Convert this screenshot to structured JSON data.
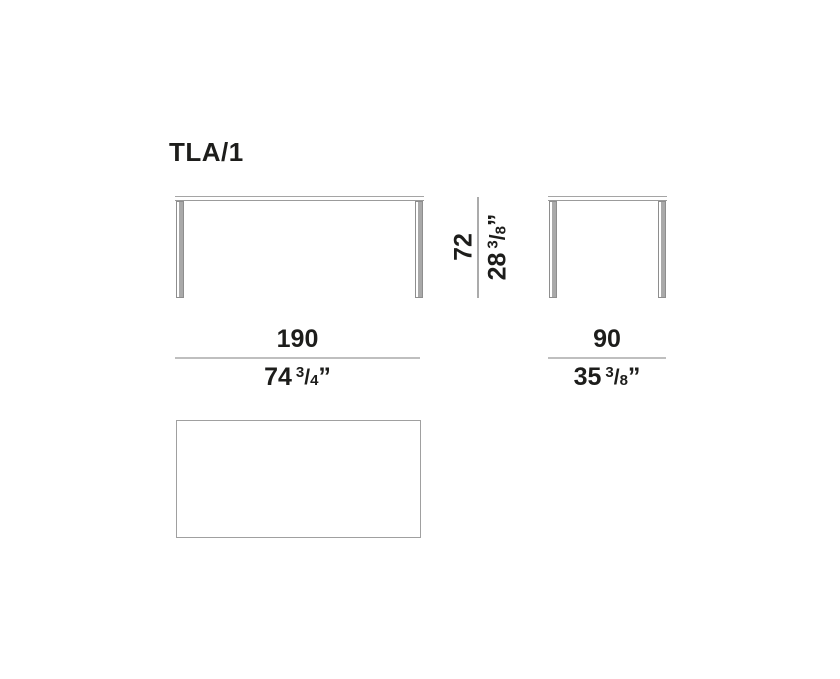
{
  "product": {
    "code": "TLA/1"
  },
  "colors": {
    "text": "#1d1d1b",
    "dimension_line": "#bfbfbf",
    "height_dimension_line": "#ababab",
    "leg_fill": "#a9a9a9",
    "leg_edge": "#8e8e8e",
    "tabletop_edge": "#a5a5a5",
    "plan_outline": "#a0a0a0",
    "background": "#ffffff"
  },
  "dimensions": {
    "height": {
      "cm": "72",
      "in_whole": "28",
      "in_num": "3",
      "in_slash": "/",
      "in_den": "8",
      "in_mark": "”"
    },
    "width": {
      "cm": "190",
      "in_whole": "74",
      "in_num": "3",
      "in_slash": "/",
      "in_den": "4",
      "in_mark": "”"
    },
    "depth": {
      "cm": "90",
      "in_whole": "35",
      "in_num": "3",
      "in_slash": "/",
      "in_den": "8",
      "in_mark": "”"
    }
  }
}
